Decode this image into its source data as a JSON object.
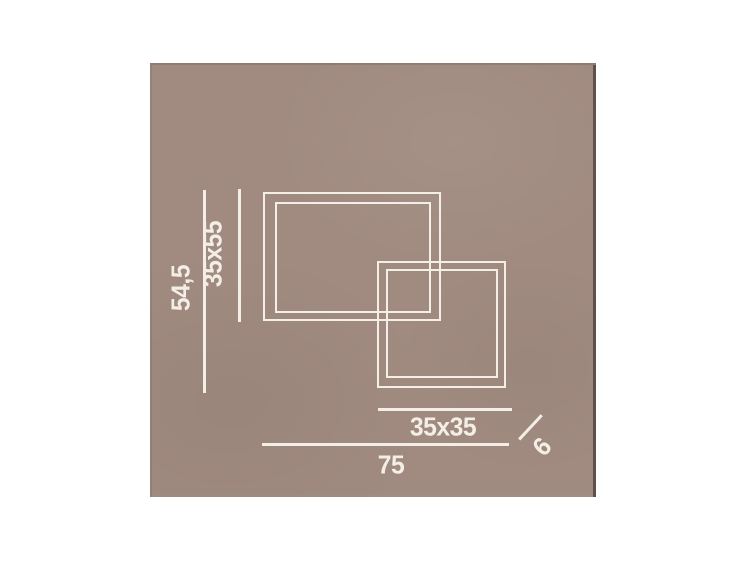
{
  "diagram": {
    "type": "product-dimension-drawing",
    "subject": "ceiling-lamp-two-overlapping-square-frames",
    "colors": {
      "panel_background": "#a18b80",
      "line_and_text": "#f4efe6",
      "page_background": "#ffffff"
    },
    "labels": {
      "total_height": "54,5",
      "large_frame_size": "35x55",
      "small_frame_size": "35x35",
      "total_width": "75",
      "frame_depth": "6"
    }
  }
}
